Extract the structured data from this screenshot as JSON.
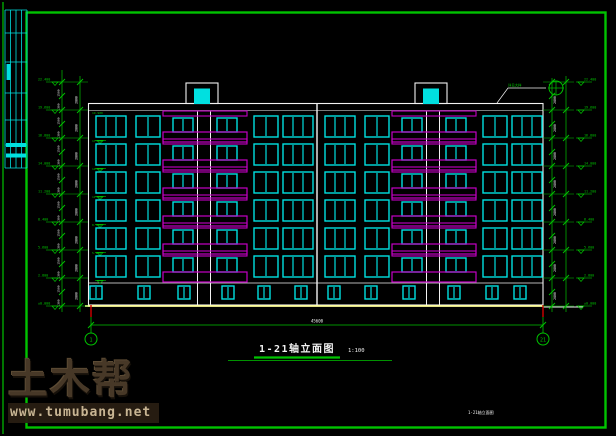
{
  "colors": {
    "line_green": "#00c300",
    "cyan": "#00e0e0",
    "magenta": "#c400c4",
    "white": "#f2f2f2",
    "yellow": "#ffff99",
    "red": "#d40000",
    "background": "#000000"
  },
  "drawing": {
    "title": "1-21轴立面图",
    "scale": "1:100",
    "footer_note": "1-21轴立面图",
    "total_width_dim": "45600",
    "roof_callout_note": "详见大样",
    "axis_left_label": "1",
    "axis_right_label": "21"
  },
  "levels": {
    "left": [
      "22.400",
      "19.600",
      "16.800",
      "14.000",
      "11.200",
      "8.400",
      "5.600",
      "2.800",
      "±0.000"
    ],
    "right": [
      "22.400",
      "19.600",
      "16.800",
      "14.000",
      "11.200",
      "8.400",
      "5.600",
      "2.800",
      "±0.000"
    ]
  },
  "dimensions": {
    "floor_heights": [
      "2800",
      "2800",
      "2800",
      "2800",
      "2800",
      "2800",
      "2800",
      "2800"
    ],
    "sub_dims": [
      "1500",
      "1300",
      "1500",
      "1300",
      "1500",
      "1300",
      "1500",
      "1300",
      "1500",
      "1300",
      "1500",
      "1300",
      "1500",
      "1300",
      "1500",
      "1300"
    ]
  },
  "floor_marks": [
    "19.900",
    "17.100",
    "14.300",
    "11.500",
    "8.700",
    "5.900"
  ],
  "watermark": {
    "brand": "土木帮",
    "url": "www.tumubang.net"
  }
}
